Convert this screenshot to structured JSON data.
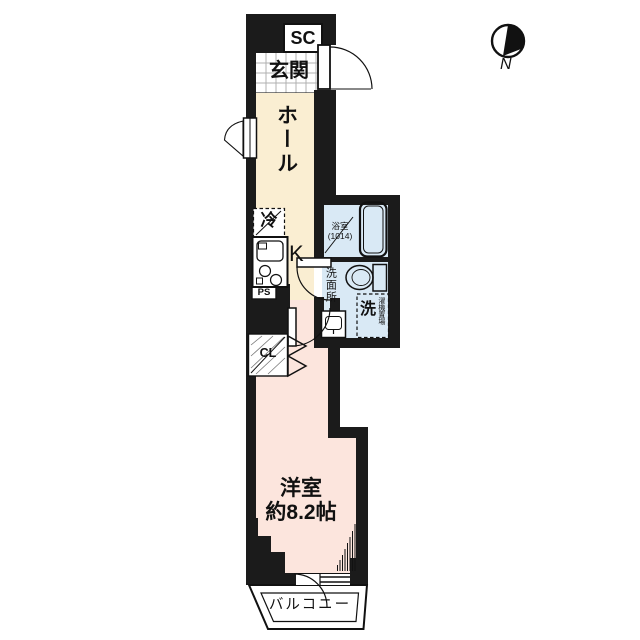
{
  "compass": {
    "label": "N"
  },
  "labels": {
    "shoe_closet": "SC",
    "entrance": "玄関",
    "hall": "ホール",
    "refrigerator": "冷",
    "kitchen": "K",
    "bathroom": "浴室",
    "bathroom_size": "(1014)",
    "washroom": "洗面所",
    "washing_machine": "洗",
    "washing_machine_sub": "濯機置場",
    "pipe_space": "PS",
    "closet": "CL",
    "bedroom": "洋室",
    "bedroom_size": "約8.2帖",
    "balcony": "バルコニー"
  },
  "colors": {
    "wall": "#1b1b1b",
    "hall_floor": "#faeed2",
    "bedroom_floor": "#fce5dd",
    "bath_floor": "#d9e9f5",
    "background": "#ffffff",
    "line": "#111111"
  }
}
